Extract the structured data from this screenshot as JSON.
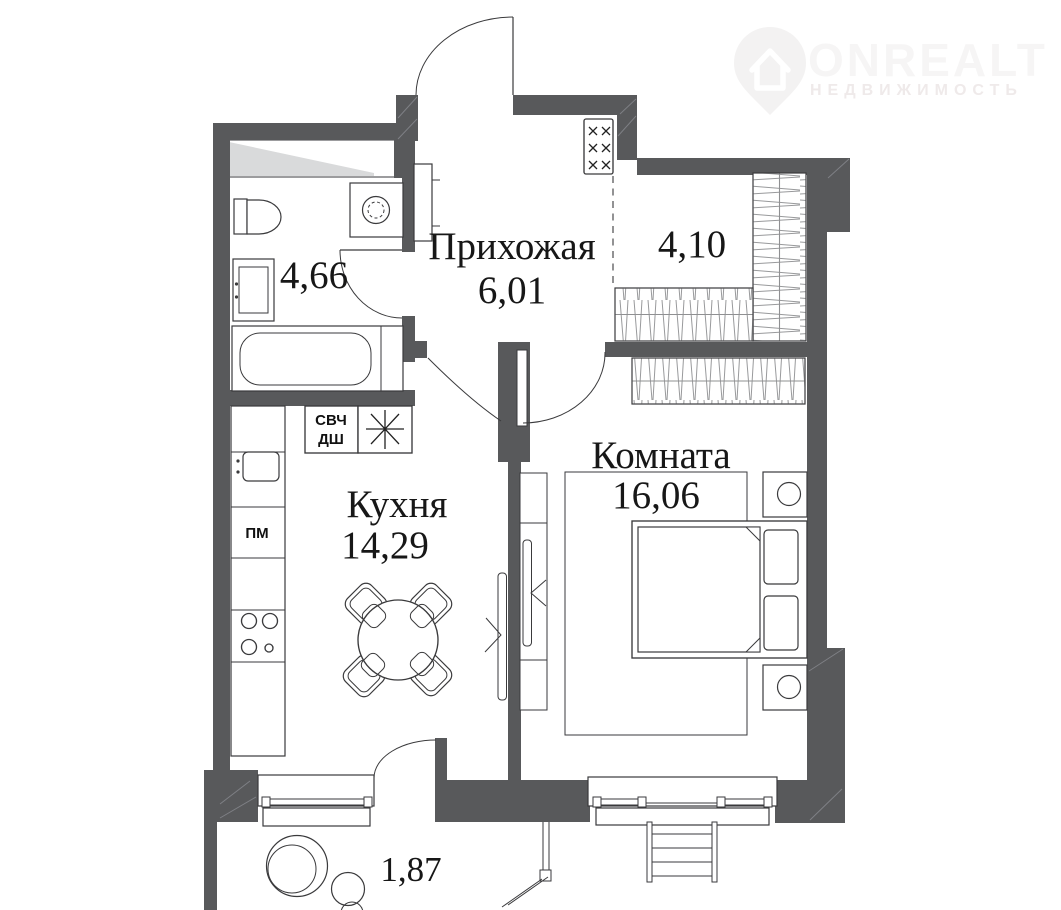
{
  "logo": {
    "brand": "ONREALT",
    "subtitle": "НЕДВИЖИМОСТЬ"
  },
  "plan": {
    "rooms": {
      "hallway": {
        "label": "Прихожая",
        "area": "6,01"
      },
      "bathroom": {
        "area": "4,66"
      },
      "dressing": {
        "area": "4,10"
      },
      "living": {
        "label": "Комната",
        "area": "16,06"
      },
      "kitchen": {
        "label": "Кухня",
        "area": "14,29"
      },
      "balcony": {
        "area": "1,87"
      }
    },
    "appliances": {
      "microwave": "СВЧ",
      "oven": "ДШ",
      "dishwasher": "ПМ"
    }
  },
  "colors": {
    "wall": "#58595b",
    "furniture_line": "#3a3a3c",
    "shaft_shading": "#d9dadb",
    "hatch": "#98999b",
    "label_text": "#171717",
    "logo_watermark": "#f4f2f2"
  }
}
